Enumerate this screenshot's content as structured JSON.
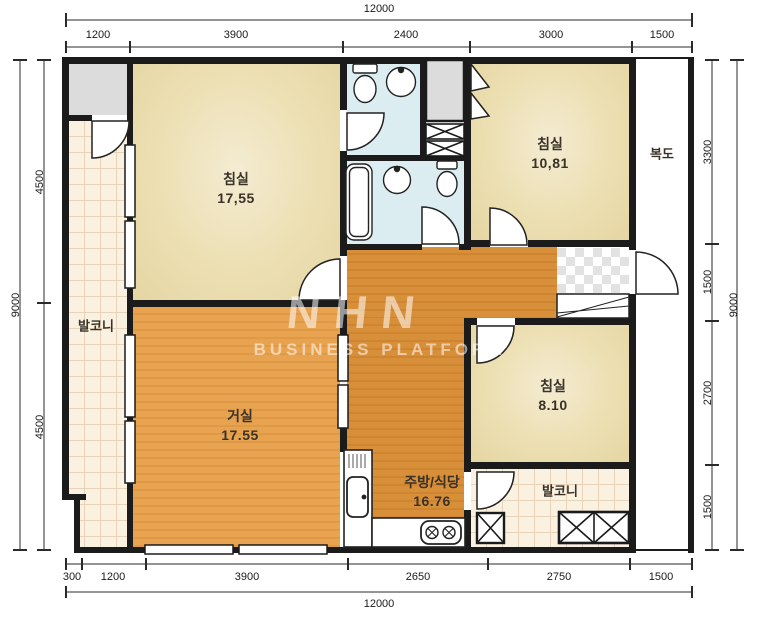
{
  "plan": {
    "watermark": {
      "logo": "NHN",
      "subtitle": "BUSINESS PLATFORM"
    },
    "rooms": {
      "bedroom1": {
        "label": "침실",
        "area": "17,55"
      },
      "bedroom2": {
        "label": "침실",
        "area": "10,81"
      },
      "bedroom3": {
        "label": "침실",
        "area": "8.10"
      },
      "living": {
        "label": "거실",
        "area": "17.55"
      },
      "kitchen": {
        "label": "주방/식당",
        "area": "16.76"
      },
      "balcony_left": {
        "label": "발코니"
      },
      "balcony_right": {
        "label": "발코니"
      },
      "corridor": {
        "label": "복도"
      }
    }
  },
  "dimensions": {
    "top": {
      "total": "12000",
      "segments": [
        "1200",
        "3900",
        "2400",
        "3000",
        "1500"
      ]
    },
    "bottom": {
      "total": "12000",
      "segments": [
        "300",
        "1200",
        "3900",
        "2650",
        "2750",
        "1500"
      ]
    },
    "left": {
      "total": "9000",
      "segments": [
        "4500",
        "4500"
      ]
    },
    "right": {
      "total": "9000",
      "segments": [
        "3300",
        "1500",
        "2700",
        "1500"
      ]
    }
  },
  "colors": {
    "wall": "#1b1b1b",
    "bedroom_floor": "#ecdfb2",
    "living_floor": "#e8a351",
    "hall_floor": "#d88f3a",
    "bathroom_floor": "#dcedf1",
    "balcony_floor": "#faf1e1",
    "utility_gray": "#dcdcdc",
    "watermark_white": "#ffffff"
  }
}
